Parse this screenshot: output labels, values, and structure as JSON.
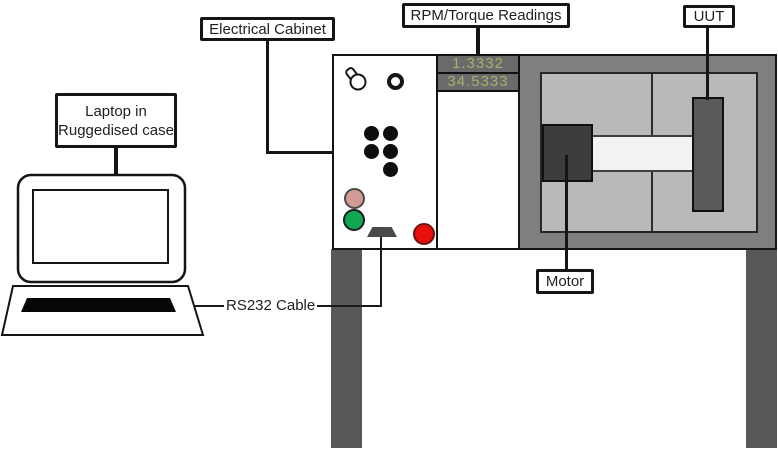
{
  "labels": {
    "electrical_cabinet": "Electrical Cabinet",
    "rpm_torque_readings": "RPM/Torque Readings",
    "uut": "UUT",
    "motor": "Motor",
    "rs232_cable": "RS232 Cable",
    "laptop_line1": "Laptop in",
    "laptop_line2": "Ruggedised case"
  },
  "readings": {
    "top": "1.3332",
    "bottom": "34.5333"
  },
  "icons": {
    "rotary_knob": "rotary-knob-icon",
    "indicator_ring": "ring-indicator-icon",
    "button_grid": "black-button-grid",
    "pink_button": "pink-status-button",
    "green_button": "green-status-button",
    "red_button": "red-stop-button",
    "serial_port": "serial-port-connector"
  },
  "colors": {
    "bench_frame": "#7f7f7f",
    "bench_panel": "#b9b9b9",
    "shaft": "#f2f2f2",
    "motor_block": "#3d3d3d",
    "uut_block": "#595959",
    "leg": "#585858",
    "display_background": "#6a6a6a",
    "display_text": "#a9ae6c",
    "button_pink": "#d49a96",
    "button_green": "#10a855",
    "button_red": "#ea0e0a",
    "outline": "#151515"
  }
}
